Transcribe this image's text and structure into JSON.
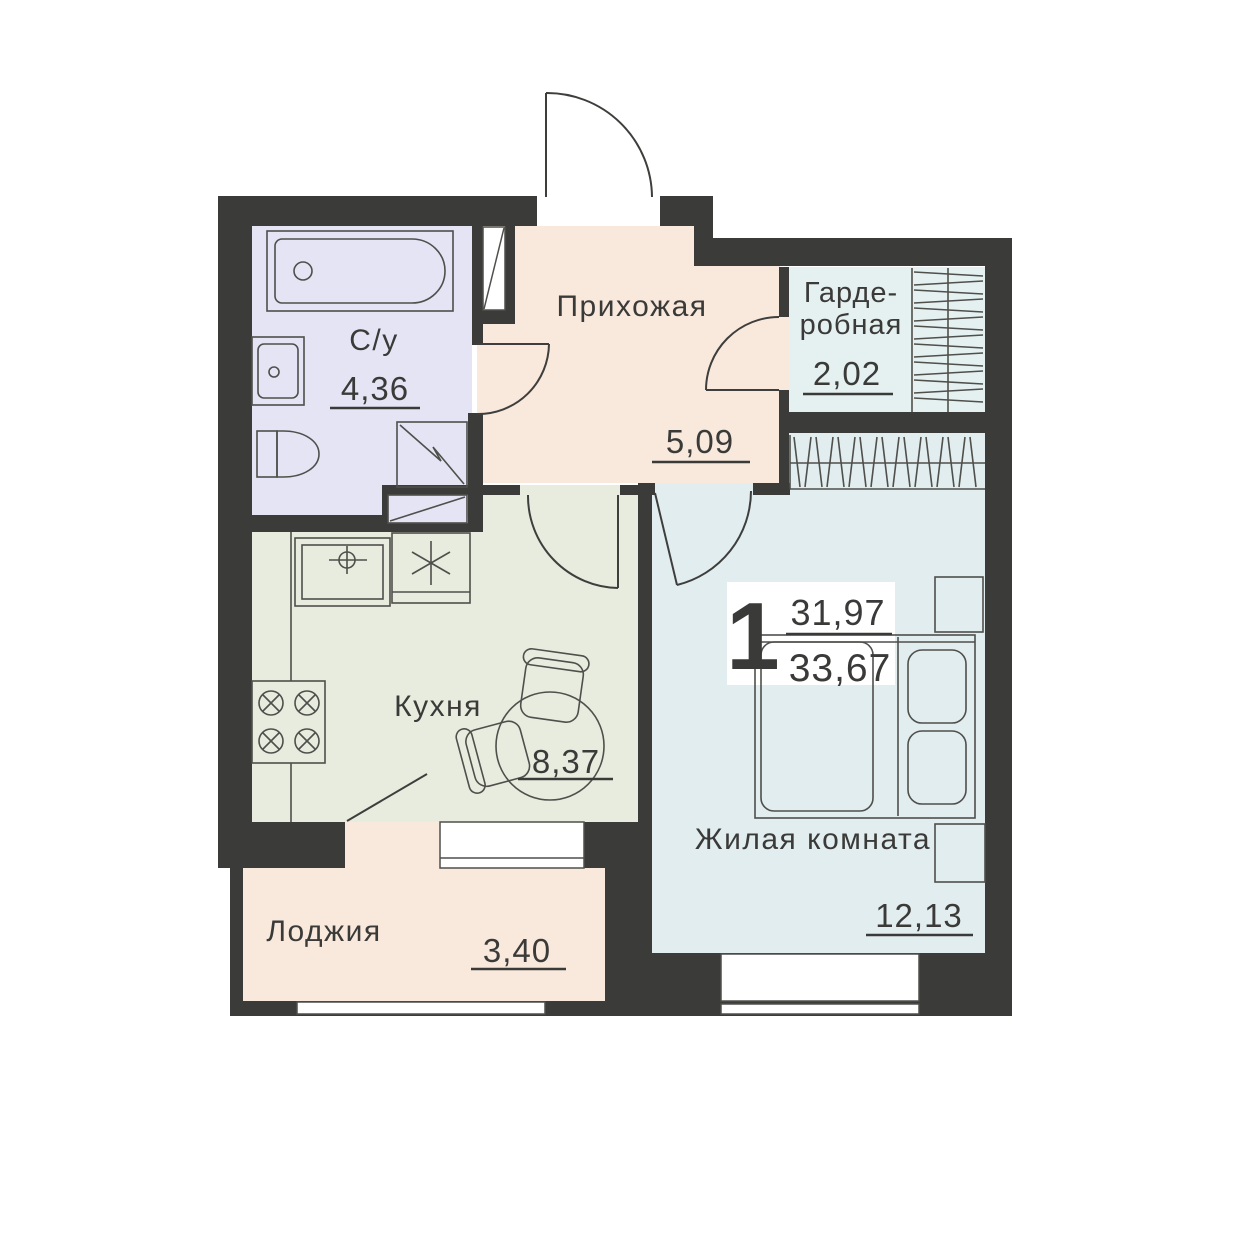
{
  "plan_title": "Floor plan of 1-room apartment",
  "apartment": {
    "rooms_count": "1",
    "living_area": "31,97",
    "total_area": "33,67"
  },
  "rooms": {
    "bathroom": {
      "label": "С/у",
      "area": "4,36"
    },
    "hallway": {
      "label": "Прихожая",
      "area": "5,09"
    },
    "wardrobe": {
      "label_line1": "Гарде-",
      "label_line2": "робная",
      "area": "2,02"
    },
    "kitchen": {
      "label": "Кухня",
      "area": "8,37"
    },
    "living": {
      "label": "Жилая комната",
      "area": "12,13"
    },
    "loggia": {
      "label": "Лоджия",
      "area": "3,40"
    }
  },
  "symbols": [
    "bathtub-icon",
    "bathroom-sink-icon",
    "toilet-icon",
    "water-heater-icon",
    "appliance-niche-icon",
    "kitchen-sink-icon",
    "hob-icon",
    "stove-burners-icon",
    "dining-table-icon",
    "chair-icon",
    "bed-icon",
    "pillow-icon",
    "nightstand-icon",
    "closet-hatch-icon",
    "door-swing-icon",
    "window-icon"
  ],
  "colors": {
    "wall": "#3b3b39",
    "bathroom": "#e4e4f5",
    "hallway": "#f9e8dc",
    "loggia": "#f9e8dc",
    "kitchen": "#e7ecdf",
    "wardrobe": "#e5f0f1",
    "living": "#e2edef",
    "white": "#ffffff",
    "furniture": "#4f4f4b",
    "door": "#3e3e3c",
    "text": "#3a3a38"
  }
}
